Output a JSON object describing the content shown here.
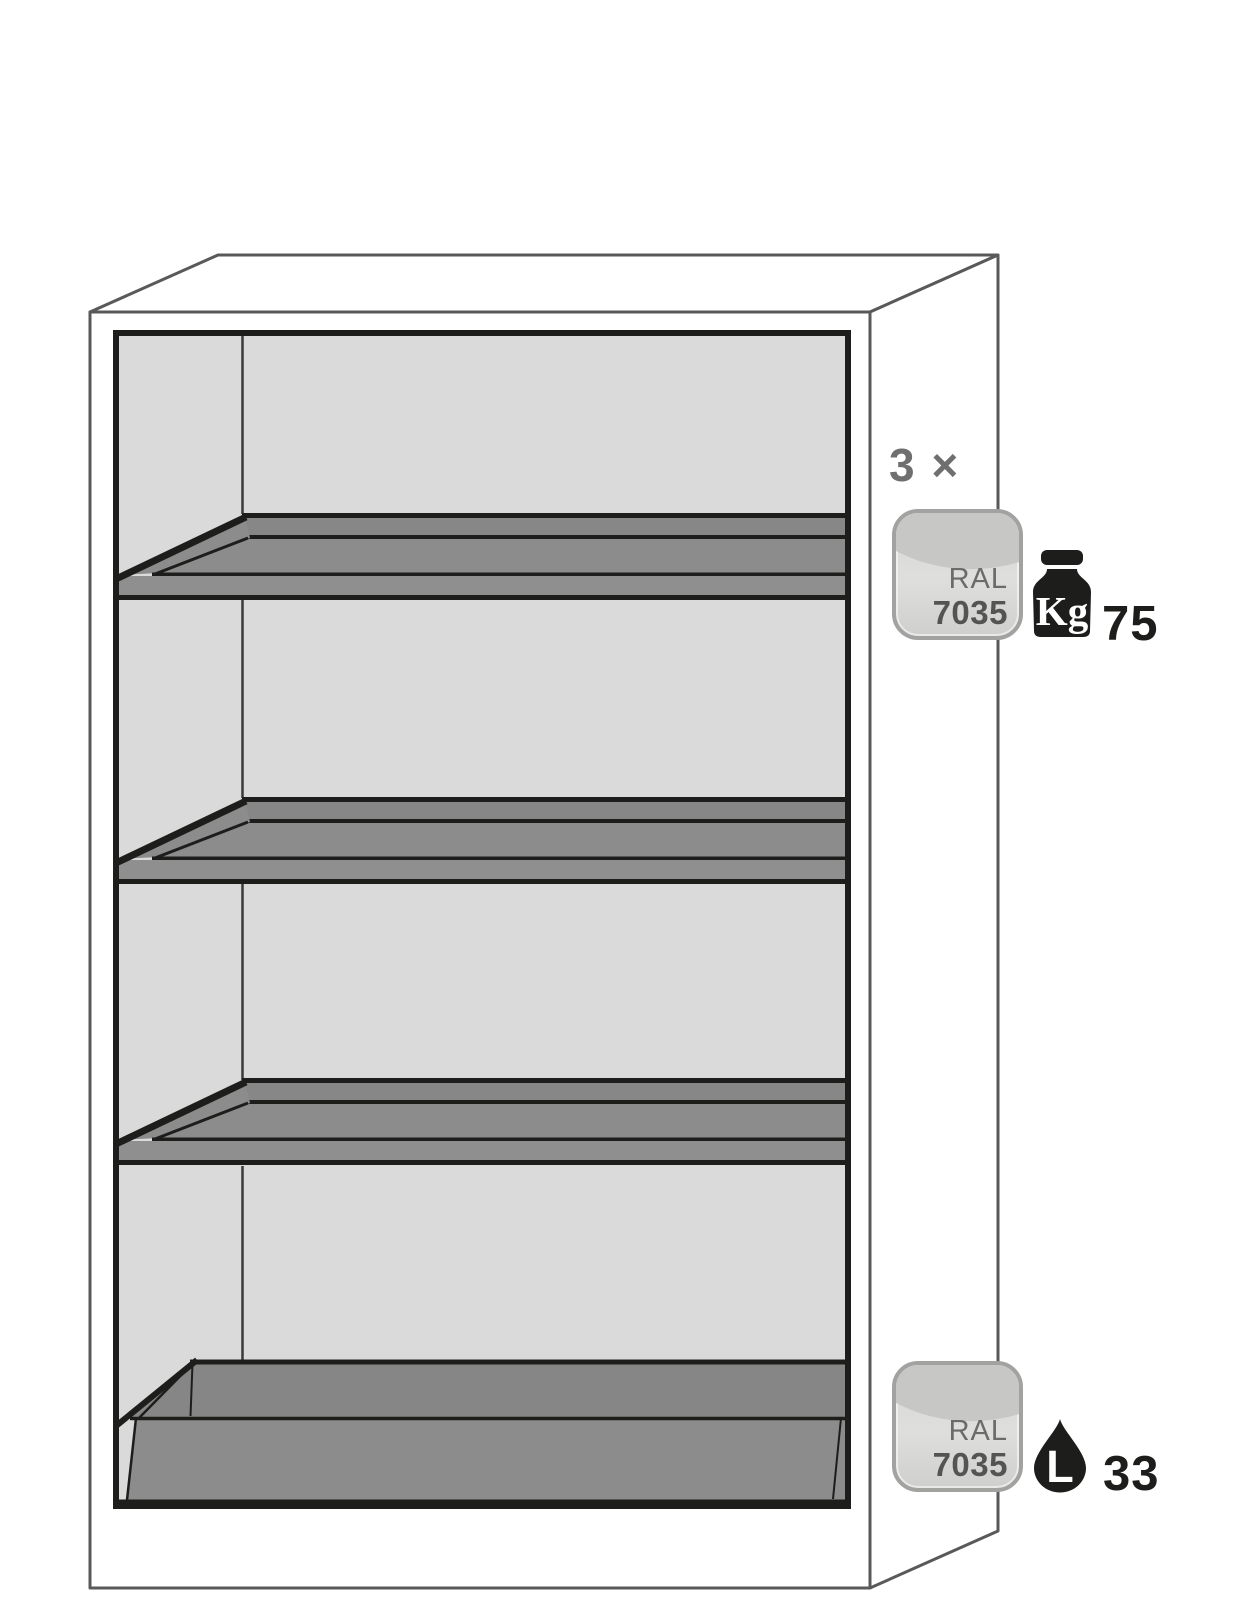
{
  "annotations": {
    "shelf": {
      "count": "3 ×",
      "badge": {
        "ral_label": "RAL",
        "ral_code": "7035"
      },
      "weight": {
        "icon_label": "Kg",
        "value": "75"
      }
    },
    "sump": {
      "badge": {
        "ral_label": "RAL",
        "ral_code": "7035"
      },
      "volume": {
        "icon_label": "L",
        "value": "33"
      }
    }
  },
  "colors": {
    "line_black": "#1d1d1b",
    "line_gray": "#59595b",
    "interior_gray": "#dadada",
    "shelf_floor_gray": "#8c8c8c",
    "shelf_band_gray": "#878787",
    "shelf_lip_gray": "#8f8f8f",
    "sump_gray": "#868686",
    "badge_border": "#a2a2a1",
    "badge_fill_top": "#c7c7c6",
    "badge_fill_bottom": "#cfcfce",
    "badge_text_secondary": "#6b6b6a",
    "badge_text_primary": "#545453",
    "count_label_gray": "#706f6f",
    "icon_black": "#1d1d1b"
  }
}
